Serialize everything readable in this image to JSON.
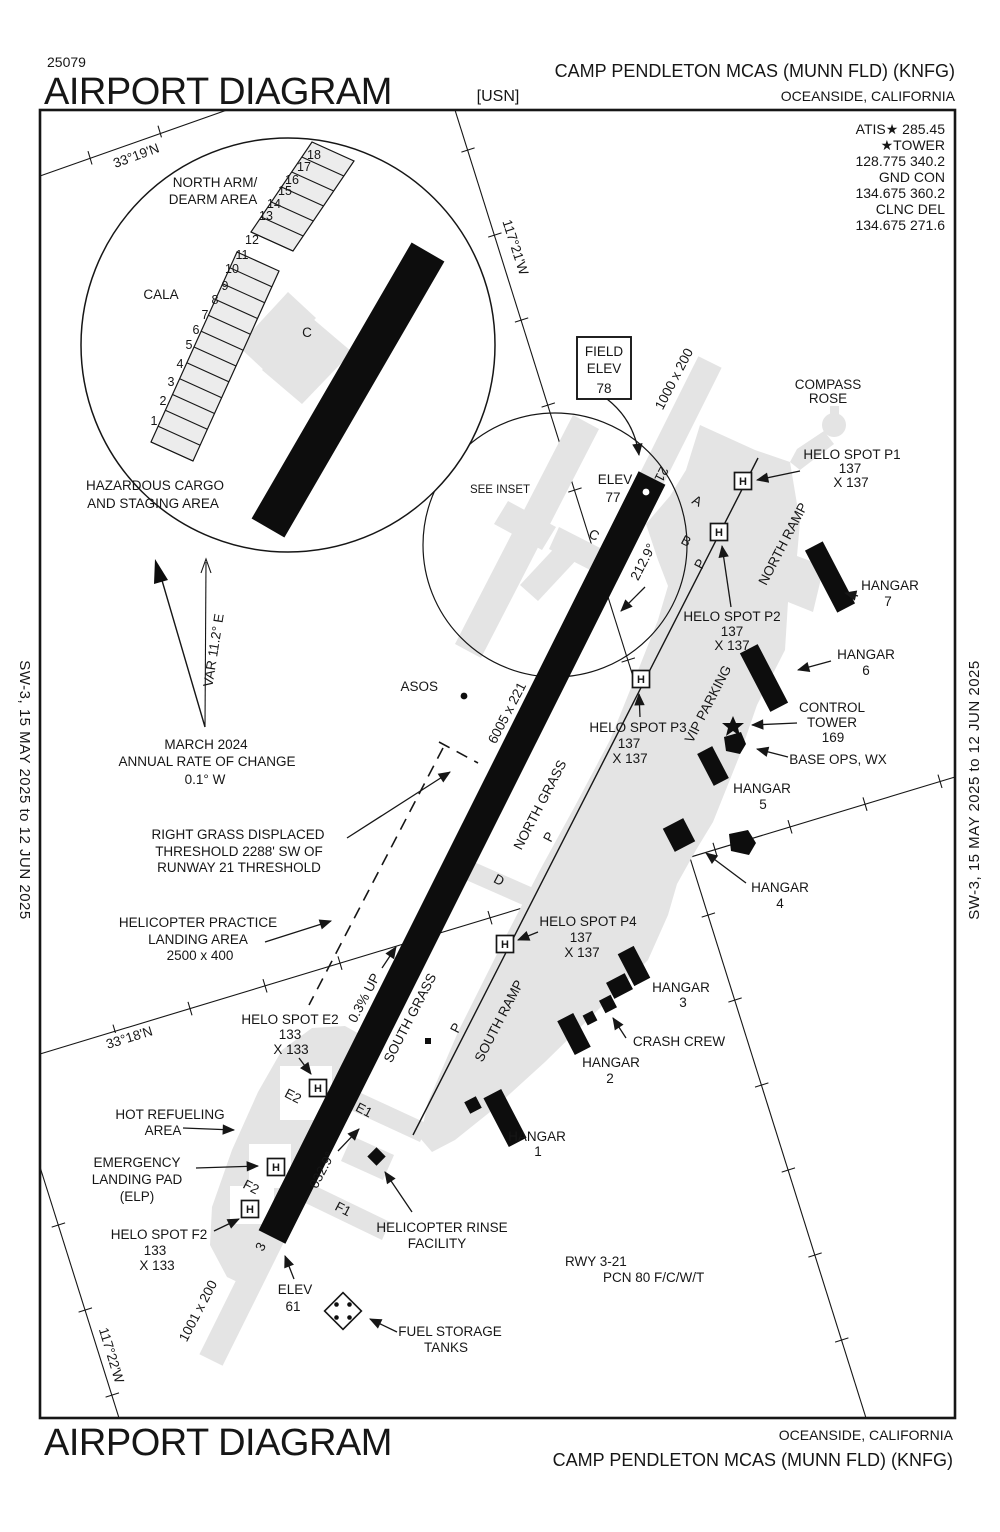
{
  "header": {
    "chart_number": "25079",
    "title": "AIRPORT DIAGRAM",
    "org": "[USN]",
    "airport": "CAMP PENDLETON MCAS (MUNN FLD)  (KNFG)",
    "city": "OCEANSIDE, CALIFORNIA"
  },
  "comms_lines": [
    "ATIS★ 285.45",
    "★TOWER",
    "128.775  340.2",
    "GND CON",
    "134.675  360.2",
    "CLNC DEL",
    "134.675 271.6"
  ],
  "margin_text": "SW-3,  15 MAY 2025  to  12 JUN 2025",
  "footer": {
    "city": "OCEANSIDE, CALIFORNIA",
    "title": "AIRPORT DIAGRAM",
    "airport": "CAMP PENDLETON MCAS (MUNN FLD)  (KNFG)"
  },
  "coords": {
    "lat19": "33°19'N",
    "lat18": "33°18'N",
    "lon21": "117°21'W",
    "lon22": "117°22'W"
  },
  "inset": {
    "north_arm": [
      "NORTH ARM/",
      "DEARM AREA"
    ],
    "cala": "CALA",
    "c": "C",
    "hazardous": [
      "HAZARDOUS CARGO",
      "AND STAGING AREA"
    ],
    "spots": [
      "1",
      "2",
      "3",
      "4",
      "5",
      "6",
      "7",
      "8",
      "9",
      "10",
      "11",
      "12",
      "13",
      "14",
      "15",
      "16",
      "17",
      "18"
    ]
  },
  "variation": {
    "var": "VAR 11.2° E",
    "lines": [
      "MARCH 2024",
      "ANNUAL RATE OF CHANGE",
      "0.1° W"
    ]
  },
  "field_elev": [
    "FIELD",
    "ELEV",
    "78"
  ],
  "see_inset": "SEE INSET",
  "asos": "ASOS",
  "compass_rose": [
    "COMPASS",
    "ROSE"
  ],
  "runway": {
    "num21": "21",
    "num3": "3",
    "hdg21": "212.9°",
    "hdg3": "032.9°",
    "dims": "6005 x 221",
    "slope": "0.3% UP",
    "overrun_north": "1000 x 200",
    "overrun_south": "1001 x 200",
    "elev_north": [
      "ELEV",
      "77"
    ],
    "elev_south": [
      "ELEV",
      "61"
    ],
    "pcn": [
      "RWY 3-21",
      "PCN 80 F/C/W/T"
    ]
  },
  "grass": {
    "north": "NORTH GRASS",
    "south": "SOUTH GRASS"
  },
  "ramps": {
    "north": "NORTH RAMP",
    "south": "SOUTH RAMP",
    "vip": "VIP PARKING"
  },
  "taxiways": {
    "a": "A",
    "b": "B",
    "c": "C",
    "d": "D",
    "p": "P",
    "e1": "E1",
    "e2": "E2",
    "f1": "F1",
    "f2": "F2"
  },
  "helo_spots": {
    "h": "H",
    "p1": [
      "HELO SPOT P1",
      "137",
      "X 137"
    ],
    "p2": [
      "HELO SPOT P2",
      "137",
      "X 137"
    ],
    "p3": [
      "HELO SPOT P3",
      "137",
      "X 137"
    ],
    "p4": [
      "HELO SPOT P4",
      "137",
      "X 137"
    ],
    "e2": [
      "HELO SPOT E2",
      "133",
      "X 133"
    ],
    "f2": [
      "HELO SPOT F2",
      "133",
      "X 133"
    ]
  },
  "buildings": {
    "hangar7": [
      "HANGAR",
      "7"
    ],
    "hangar6": [
      "HANGAR",
      "6"
    ],
    "hangar5": [
      "HANGAR",
      "5"
    ],
    "hangar4": [
      "HANGAR",
      "4"
    ],
    "hangar3": [
      "HANGAR",
      "3"
    ],
    "hangar2": [
      "HANGAR",
      "2"
    ],
    "hangar1": [
      "HANGAR",
      "1"
    ],
    "control_tower": [
      "CONTROL",
      "TOWER",
      "169"
    ],
    "base_ops": "BASE OPS, WX",
    "crash_crew": "CRASH CREW",
    "rinse": [
      "HELICOPTER RINSE",
      "FACILITY"
    ],
    "fuel": [
      "FUEL STORAGE",
      "TANKS"
    ]
  },
  "notes": {
    "displaced": [
      "RIGHT GRASS DISPLACED",
      "THRESHOLD 2288' SW OF",
      "RUNWAY 21 THRESHOLD"
    ],
    "practice": [
      "HELICOPTER PRACTICE",
      "LANDING AREA",
      "2500 x 400"
    ],
    "hot_refuel": [
      "HOT REFUELING",
      "AREA"
    ],
    "elp": [
      "EMERGENCY",
      "LANDING PAD",
      "(ELP)"
    ]
  },
  "colors": {
    "ink": "#161616",
    "ramp_gray": "#e4e4e4",
    "paper": "#ffffff"
  }
}
